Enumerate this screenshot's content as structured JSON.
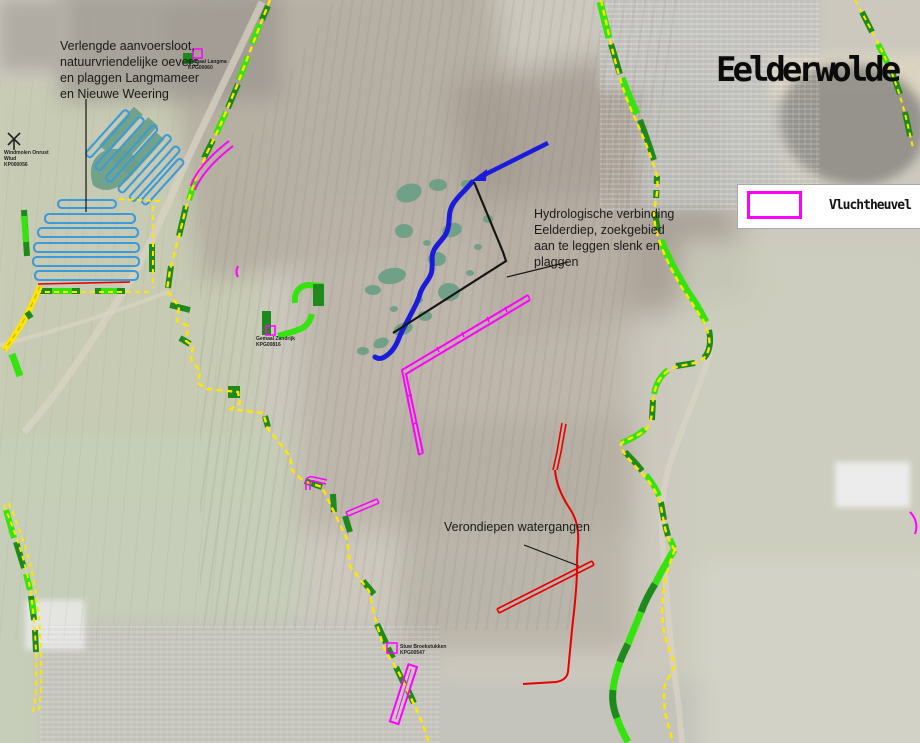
{
  "title": "Eelderwolde",
  "legend": {
    "items": [
      {
        "label": "Vluchtheuvel",
        "swatch_color": "#ff00ff"
      }
    ]
  },
  "annotations": {
    "aanvoersloot": {
      "lines": [
        "Verlengde aanvoersloot,",
        "natuurvriendelijke oevers",
        "en plaggen Langmameer",
        "en Nieuwe Weering"
      ]
    },
    "hydrologische": {
      "lines": [
        "Hydrologische verbinding",
        "Eelderdiep, zoekgebied",
        "aan te leggen slenk en",
        "plaggen"
      ]
    },
    "verondiepen": {
      "label": "Verondiepen watergangen"
    }
  },
  "markers": {
    "gemaal_langma": {
      "lines": [
        "Gemaal Langma",
        "KPG00060"
      ]
    },
    "windmolen": {
      "lines": [
        "Windmolen Onrust",
        "Wiud",
        "KP000056"
      ]
    },
    "gemaal_zandrijk": {
      "lines": [
        "Gemaal Zandrijk",
        "KPG00816"
      ]
    },
    "stuw": {
      "lines": [
        "Stuw Broekstukken",
        "KPG00547"
      ]
    }
  },
  "colors": {
    "boundary": "#ffe600",
    "green_dark": "#1d8a1b",
    "green_bright": "#35e40e",
    "magenta": "#ff00ff",
    "red": "#e80000",
    "blue_river": "#1b1bdc",
    "blue_ditch": "#3d9ad8",
    "teal": "#6a9e85"
  }
}
